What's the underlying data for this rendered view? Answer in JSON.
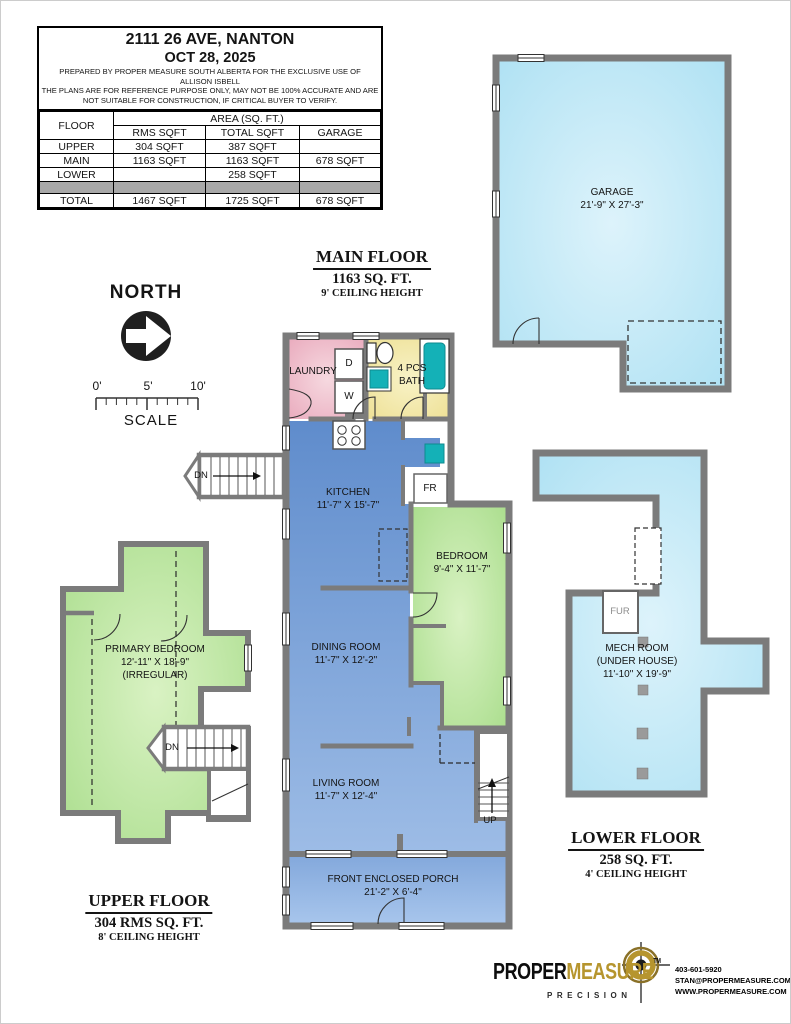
{
  "info_box": {
    "address": "2111 26 AVE, NANTON",
    "date": "OCT 28, 2025",
    "prepared1": "PREPARED BY PROPER MEASURE SOUTH ALBERTA FOR THE EXCLUSIVE USE OF",
    "prepared2": "ALLISON ISBELL",
    "disclaimer1": "THE PLANS ARE FOR REFERENCE PURPOSE ONLY, MAY NOT BE 100% ACCURATE AND ARE",
    "disclaimer2": "NOT SUITABLE FOR CONSTRUCTION, IF CRITICAL BUYER TO VERIFY."
  },
  "area_table": {
    "floor_header": "FLOOR",
    "area_header": "AREA (SQ. FT.)",
    "sub_headers": {
      "rms": "RMS SQFT",
      "total": "TOTAL SQFT",
      "garage": "GARAGE"
    },
    "rows": [
      {
        "floor": "UPPER",
        "rms": "304 SQFT",
        "total": "387 SQFT",
        "garage": ""
      },
      {
        "floor": "MAIN",
        "rms": "1163 SQFT",
        "total": "1163 SQFT",
        "garage": "678 SQFT"
      },
      {
        "floor": "LOWER",
        "rms": "",
        "total": "258 SQFT",
        "garage": ""
      }
    ],
    "total": {
      "floor": "TOTAL",
      "rms": "1467 SQFT",
      "total": "1725 SQFT",
      "garage": "678 SQFT"
    }
  },
  "compass": {
    "label": "NORTH"
  },
  "scalebar": {
    "tick0": "0'",
    "tick5": "5'",
    "tick10": "10'",
    "label": "SCALE"
  },
  "floor_titles": {
    "main": {
      "title": "MAIN FLOOR",
      "area": "1163 SQ. FT.",
      "ceiling": "9' CEILING HEIGHT"
    },
    "upper": {
      "title": "UPPER FLOOR",
      "area": "304 RMS SQ. FT.",
      "ceiling": "8' CEILING HEIGHT"
    },
    "lower": {
      "title": "LOWER FLOOR",
      "area": "258 SQ. FT.",
      "ceiling": "4' CEILING HEIGHT"
    }
  },
  "rooms": {
    "garage": {
      "name": "GARAGE",
      "dims": "21'-9\" X 27'-3\""
    },
    "laundry": {
      "name": "LAUNDRY"
    },
    "bath": {
      "line1": "4 PCS",
      "line2": "BATH"
    },
    "kitchen": {
      "name": "KITCHEN",
      "dims": "11'-7\" X 15'-7\""
    },
    "bedroom": {
      "name": "BEDROOM",
      "dims": "9'-4\" X 11'-7\""
    },
    "dining": {
      "name": "DINING ROOM",
      "dims": "11'-7\" X 12'-2\""
    },
    "living": {
      "name": "LIVING ROOM",
      "dims": "11'-7\" X 12'-4\""
    },
    "porch": {
      "name": "FRONT ENCLOSED PORCH",
      "dims": "21'-2\" X 6'-4\""
    },
    "primary_bedroom": {
      "name": "PRIMARY BEDROOM",
      "dims": "12'-11\" X 18'-9\"",
      "note": "(IRREGULAR)"
    },
    "mech": {
      "line1": "MECH ROOM",
      "line2": "(UNDER HOUSE)",
      "dims": "11'-10\" X 19'-9\""
    }
  },
  "labels": {
    "dryer": "D",
    "washer": "W",
    "fridge": "FR",
    "furnace": "FUR",
    "up": "UP",
    "dn_main": "DN",
    "dn_upper": "DN"
  },
  "logo": {
    "brand_black": "PROPER",
    "brand_gold": "MEASURE",
    "tm": "TM",
    "tagline": "PRECISION",
    "phone": "403-601-5920",
    "email": "STAN@PROPERMEASURE.COM",
    "website": "WWW.PROPERMEASURE.COM"
  },
  "colors": {
    "wall": "#7b7b7b",
    "room_blue": "#5f8ccc",
    "room_blue_light": "#9dbce6",
    "laundry_pink": "#e9a9bc",
    "bath_yellow": "#eddf92",
    "bedroom_green": "#a5db87",
    "basement_cyan": "#a9dff2",
    "fixture_teal": "#14b1b7",
    "brand_gold": "#b6952e",
    "table_gray": "#a8a8a8"
  }
}
